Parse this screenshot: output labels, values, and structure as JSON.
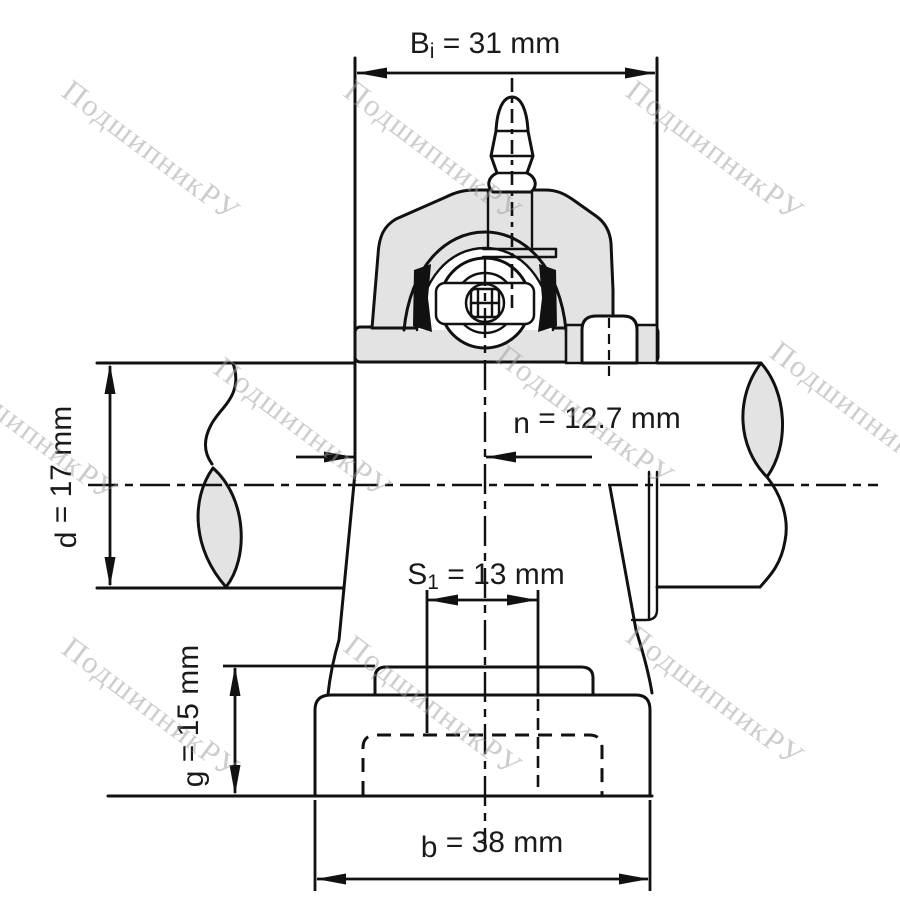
{
  "watermark": {
    "text": "ПодшипникРУ"
  },
  "dimensions": {
    "Bi": {
      "symbol": "B",
      "sub": "i",
      "rest": " = 31 mm"
    },
    "n": {
      "symbol": "n",
      "sub": "",
      "rest": " = 12.7 mm"
    },
    "d": {
      "symbol": "d",
      "sub": "",
      "rest": " = 17 mm"
    },
    "S1": {
      "symbol": "S",
      "sub": "1",
      "rest": " = 13 mm"
    },
    "g": {
      "symbol": "g",
      "sub": "",
      "rest": " = 15 mm"
    },
    "b": {
      "symbol": "b",
      "sub": "",
      "rest": " = 38 mm"
    }
  },
  "colors": {
    "line": "#111111",
    "section_gray": "#e3e3e3",
    "watermark_gray": "#9d9d9d",
    "background": "#ffffff"
  }
}
